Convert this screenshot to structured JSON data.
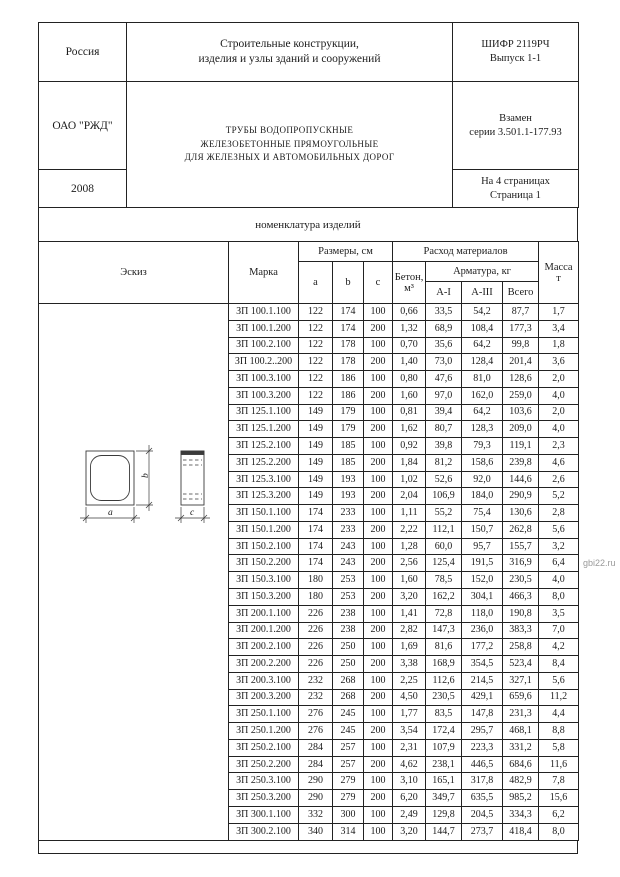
{
  "title_block": {
    "country": "Россия",
    "organization": "ОАО \"РЖД\"",
    "year": "2008",
    "catalog_title": [
      "Строительные конструкции,",
      "изделия и узлы зданий и сооружений"
    ],
    "product_title": [
      "ТРУБЫ ВОДОПРОПУСКНЫЕ",
      "ЖЕЛЕЗОБЕТОННЫЕ ПРЯМОУГОЛЬНЫЕ",
      "ДЛЯ ЖЕЛЕЗНЫХ И АВТОМОБИЛЬНЫХ ДОРОГ"
    ],
    "cipher": [
      "ШИФР 2119РЧ",
      "Выпуск 1-1"
    ],
    "replaces": [
      "Взамен",
      "серии 3.501.1-177.93"
    ],
    "pagination": [
      "На 4 страницах",
      "Страница 1"
    ]
  },
  "section_title": "номенклатура изделий",
  "watermark": "gbi22.ru",
  "colors": {
    "border": "#222222",
    "text": "#1c1c1c",
    "watermark": "#9a9a9a"
  },
  "table": {
    "headers": {
      "sketch": "Эскиз",
      "mark": "Марка",
      "dimensions": "Размеры, см",
      "dim_a": "a",
      "dim_b": "b",
      "dim_c": "c",
      "materials": "Расход материалов",
      "concrete": [
        "Бетон,",
        "м³"
      ],
      "rebar": "Арматура, кг",
      "rebar_a1": "А-I",
      "rebar_a3": "А-III",
      "rebar_total": "Всего",
      "mass": [
        "Масса",
        "т"
      ]
    },
    "sketch_labels": {
      "a": "a",
      "b": "b",
      "c": "c"
    },
    "rows": [
      {
        "mark": "ЗП 100.1.100",
        "a": "122",
        "b": "174",
        "c": "100",
        "concrete": "0,66",
        "a1": "33,5",
        "a3": "54,2",
        "total": "87,7",
        "mass": "1,7"
      },
      {
        "mark": "ЗП 100.1.200",
        "a": "122",
        "b": "174",
        "c": "200",
        "concrete": "1,32",
        "a1": "68,9",
        "a3": "108,4",
        "total": "177,3",
        "mass": "3,4"
      },
      {
        "mark": "ЗП 100.2.100",
        "a": "122",
        "b": "178",
        "c": "100",
        "concrete": "0,70",
        "a1": "35,6",
        "a3": "64,2",
        "total": "99,8",
        "mass": "1,8"
      },
      {
        "mark": "ЗП 100.2..200",
        "a": "122",
        "b": "178",
        "c": "200",
        "concrete": "1,40",
        "a1": "73,0",
        "a3": "128,4",
        "total": "201,4",
        "mass": "3,6"
      },
      {
        "mark": "ЗП 100.3.100",
        "a": "122",
        "b": "186",
        "c": "100",
        "concrete": "0,80",
        "a1": "47,6",
        "a3": "81,0",
        "total": "128,6",
        "mass": "2,0"
      },
      {
        "mark": "ЗП 100.3.200",
        "a": "122",
        "b": "186",
        "c": "200",
        "concrete": "1,60",
        "a1": "97,0",
        "a3": "162,0",
        "total": "259,0",
        "mass": "4,0"
      },
      {
        "mark": "ЗП 125.1.100",
        "a": "149",
        "b": "179",
        "c": "100",
        "concrete": "0,81",
        "a1": "39,4",
        "a3": "64,2",
        "total": "103,6",
        "mass": "2,0"
      },
      {
        "mark": "ЗП 125.1.200",
        "a": "149",
        "b": "179",
        "c": "200",
        "concrete": "1,62",
        "a1": "80,7",
        "a3": "128,3",
        "total": "209,0",
        "mass": "4,0"
      },
      {
        "mark": "ЗП 125.2.100",
        "a": "149",
        "b": "185",
        "c": "100",
        "concrete": "0,92",
        "a1": "39,8",
        "a3": "79,3",
        "total": "119,1",
        "mass": "2,3"
      },
      {
        "mark": "ЗП 125.2.200",
        "a": "149",
        "b": "185",
        "c": "200",
        "concrete": "1,84",
        "a1": "81,2",
        "a3": "158,6",
        "total": "239,8",
        "mass": "4,6"
      },
      {
        "mark": "ЗП 125.3.100",
        "a": "149",
        "b": "193",
        "c": "100",
        "concrete": "1,02",
        "a1": "52,6",
        "a3": "92,0",
        "total": "144,6",
        "mass": "2,6"
      },
      {
        "mark": "ЗП 125.3.200",
        "a": "149",
        "b": "193",
        "c": "200",
        "concrete": "2,04",
        "a1": "106,9",
        "a3": "184,0",
        "total": "290,9",
        "mass": "5,2"
      },
      {
        "mark": "ЗП 150.1.100",
        "a": "174",
        "b": "233",
        "c": "100",
        "concrete": "1,11",
        "a1": "55,2",
        "a3": "75,4",
        "total": "130,6",
        "mass": "2,8"
      },
      {
        "mark": "ЗП 150.1.200",
        "a": "174",
        "b": "233",
        "c": "200",
        "concrete": "2,22",
        "a1": "112,1",
        "a3": "150,7",
        "total": "262,8",
        "mass": "5,6"
      },
      {
        "mark": "ЗП 150.2.100",
        "a": "174",
        "b": "243",
        "c": "100",
        "concrete": "1,28",
        "a1": "60,0",
        "a3": "95,7",
        "total": "155,7",
        "mass": "3,2"
      },
      {
        "mark": "ЗП 150.2.200",
        "a": "174",
        "b": "243",
        "c": "200",
        "concrete": "2,56",
        "a1": "125,4",
        "a3": "191,5",
        "total": "316,9",
        "mass": "6,4"
      },
      {
        "mark": "ЗП 150.3.100",
        "a": "180",
        "b": "253",
        "c": "100",
        "concrete": "1,60",
        "a1": "78,5",
        "a3": "152,0",
        "total": "230,5",
        "mass": "4,0"
      },
      {
        "mark": "ЗП 150.3.200",
        "a": "180",
        "b": "253",
        "c": "200",
        "concrete": "3,20",
        "a1": "162,2",
        "a3": "304,1",
        "total": "466,3",
        "mass": "8,0"
      },
      {
        "mark": "ЗП 200.1.100",
        "a": "226",
        "b": "238",
        "c": "100",
        "concrete": "1,41",
        "a1": "72,8",
        "a3": "118,0",
        "total": "190,8",
        "mass": "3,5"
      },
      {
        "mark": "ЗП 200.1.200",
        "a": "226",
        "b": "238",
        "c": "200",
        "concrete": "2,82",
        "a1": "147,3",
        "a3": "236,0",
        "total": "383,3",
        "mass": "7,0"
      },
      {
        "mark": "ЗП 200.2.100",
        "a": "226",
        "b": "250",
        "c": "100",
        "concrete": "1,69",
        "a1": "81,6",
        "a3": "177,2",
        "total": "258,8",
        "mass": "4,2"
      },
      {
        "mark": "ЗП 200.2.200",
        "a": "226",
        "b": "250",
        "c": "200",
        "concrete": "3,38",
        "a1": "168,9",
        "a3": "354,5",
        "total": "523,4",
        "mass": "8,4"
      },
      {
        "mark": "ЗП 200.3.100",
        "a": "232",
        "b": "268",
        "c": "100",
        "concrete": "2,25",
        "a1": "112,6",
        "a3": "214,5",
        "total": "327,1",
        "mass": "5,6"
      },
      {
        "mark": "ЗП 200.3.200",
        "a": "232",
        "b": "268",
        "c": "200",
        "concrete": "4,50",
        "a1": "230,5",
        "a3": "429,1",
        "total": "659,6",
        "mass": "11,2"
      },
      {
        "mark": "ЗП 250.1.100",
        "a": "276",
        "b": "245",
        "c": "100",
        "concrete": "1,77",
        "a1": "83,5",
        "a3": "147,8",
        "total": "231,3",
        "mass": "4,4"
      },
      {
        "mark": "ЗП 250.1.200",
        "a": "276",
        "b": "245",
        "c": "200",
        "concrete": "3,54",
        "a1": "172,4",
        "a3": "295,7",
        "total": "468,1",
        "mass": "8,8"
      },
      {
        "mark": "ЗП 250.2.100",
        "a": "284",
        "b": "257",
        "c": "100",
        "concrete": "2,31",
        "a1": "107,9",
        "a3": "223,3",
        "total": "331,2",
        "mass": "5,8"
      },
      {
        "mark": "ЗП 250.2.200",
        "a": "284",
        "b": "257",
        "c": "200",
        "concrete": "4,62",
        "a1": "238,1",
        "a3": "446,5",
        "total": "684,6",
        "mass": "11,6"
      },
      {
        "mark": "ЗП 250.3.100",
        "a": "290",
        "b": "279",
        "c": "100",
        "concrete": "3,10",
        "a1": "165,1",
        "a3": "317,8",
        "total": "482,9",
        "mass": "7,8"
      },
      {
        "mark": "ЗП 250.3.200",
        "a": "290",
        "b": "279",
        "c": "200",
        "concrete": "6,20",
        "a1": "349,7",
        "a3": "635,5",
        "total": "985,2",
        "mass": "15,6"
      },
      {
        "mark": "ЗП 300.1.100",
        "a": "332",
        "b": "300",
        "c": "100",
        "concrete": "2,49",
        "a1": "129,8",
        "a3": "204,5",
        "total": "334,3",
        "mass": "6,2"
      },
      {
        "mark": "ЗП 300.2.100",
        "a": "340",
        "b": "314",
        "c": "100",
        "concrete": "3,20",
        "a1": "144,7",
        "a3": "273,7",
        "total": "418,4",
        "mass": "8,0"
      }
    ]
  }
}
